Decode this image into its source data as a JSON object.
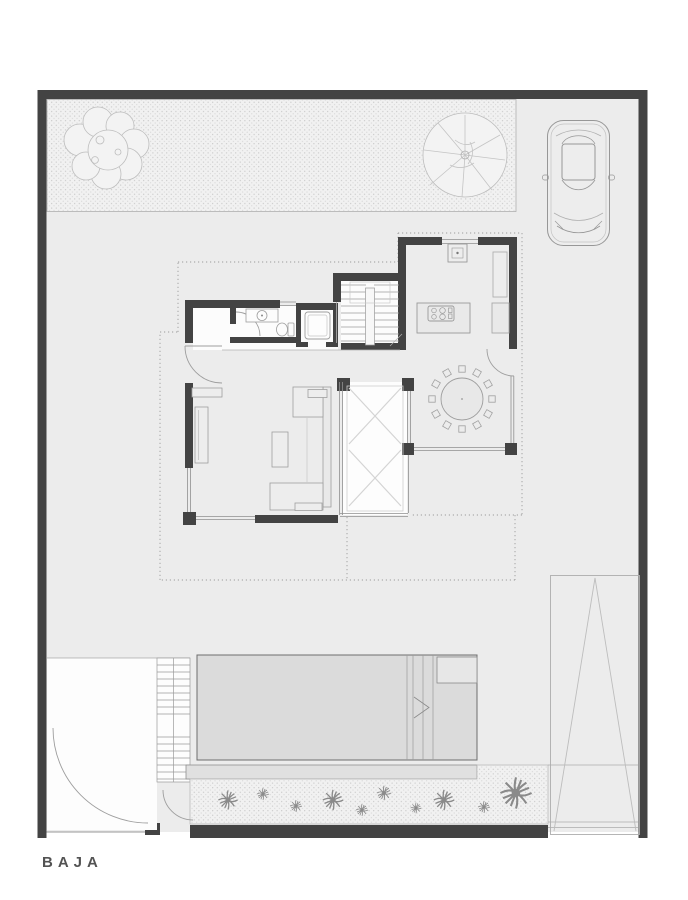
{
  "plan": {
    "floor_label": "BAJA",
    "type": "architectural-floor-plan",
    "features": [
      "site-boundary",
      "front-garden",
      "deciduous-tree",
      "palm-tree",
      "parked-car",
      "upper-floor-dotted-outline",
      "kitchen",
      "kitchen-sink",
      "island-cooktop",
      "tall-cabinet",
      "main-staircase",
      "elevator",
      "bathroom",
      "vanity-sink",
      "toilet",
      "entry-door",
      "living-room",
      "tv-unit",
      "sofa-set",
      "side-table",
      "double-height-courtyard",
      "dining-room",
      "round-dining-table",
      "dining-chairs",
      "swimming-pool",
      "pool-ledge",
      "overflow-gutter",
      "planting-bed",
      "garden-shrubs",
      "outdoor-staircase",
      "entry-court",
      "pedestrian-gate",
      "service-gate",
      "driveway-gate"
    ]
  },
  "colors": {
    "page_bg": "#ffffff",
    "site_fill": "#ececec",
    "wall_dark": "#434343",
    "stipple_bg": "#f1f1f1",
    "stipple_dot": "#c7c7c7",
    "white_room": "#fcfcfc",
    "pool_fill": "#dbdbdb",
    "line_mid": "#8f8f8f",
    "line_light": "#b8b8b8",
    "label_text": "#535353"
  }
}
